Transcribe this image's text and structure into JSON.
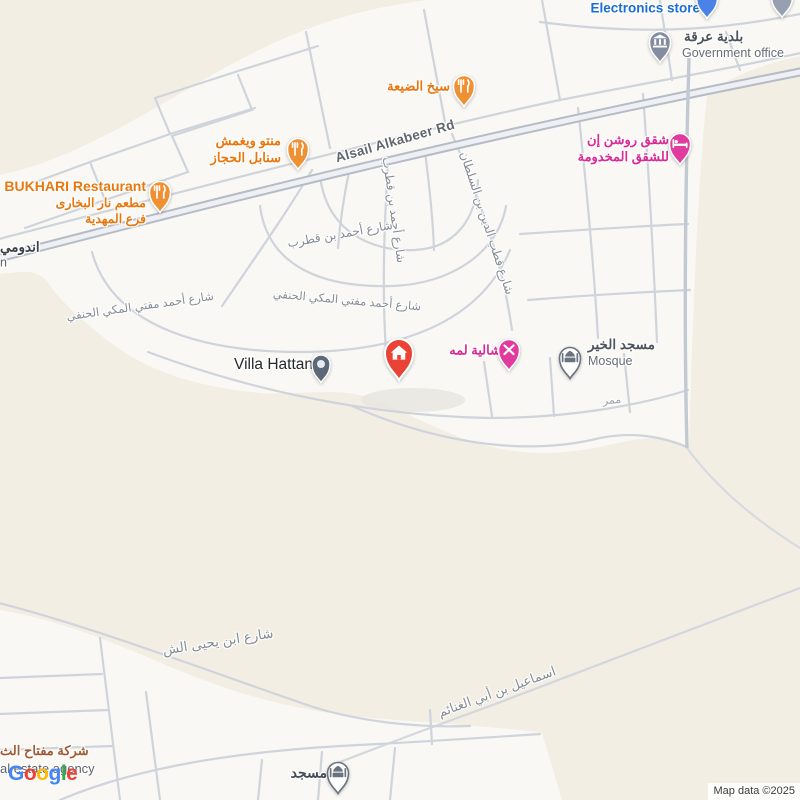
{
  "attribution": "Map data ©2025",
  "logo": {
    "letters": [
      "G",
      "o",
      "o",
      "g",
      "l",
      "e"
    ]
  },
  "colors": {
    "land": "#f2eee3",
    "urban": "#f9f8f4",
    "road": "#cfd4dc",
    "restaurant_label": "#e8770f",
    "pink_label": "#d92a95",
    "blue_label": "#1a6dd8",
    "civic_label": "#4c535b",
    "street_label": "#858c96",
    "red_pin": "#ea4335",
    "marker_orange": "#ef9133",
    "marker_pink": "#e23ba0",
    "marker_blue": "#4a82e8",
    "marker_gray": "#848da0"
  },
  "roads": {
    "alsail": "Alsail Alkabeer Rd",
    "qatrab_v": "شارع أحمد بن قطرب",
    "qatrab_h": "شارع أحمد بن قطرب",
    "mufti_a": "شارع أحمد مفتي المكي الحنفي",
    "mufti_b": "شارع أحمد مفتي المكي الحنفي",
    "qutb": "شارع قطب الدين بن السلطان",
    "yahya": "شارع ابن يحيى الش",
    "ismail": "اسماعيل بن أبي الغنائم",
    "mamarr": "ممر"
  },
  "pois": {
    "electronics": {
      "name": "Electronics store",
      "icon": "pin-icon"
    },
    "government": {
      "name": "بلدية عرقة",
      "subtitle": "Government office",
      "icon": "bank-icon"
    },
    "sikh": {
      "name": "سيخ الضيعة",
      "icon": "restaurant-icon"
    },
    "manto": {
      "line1": "منتو ويغمش",
      "line2": "سنابل الحجاز",
      "icon": "restaurant-icon"
    },
    "bukhari": {
      "name": "BUKHARI Restaurant",
      "line1": "مطعم نار البخاری",
      "line2": "فرع المهدية",
      "icon": "restaurant-icon"
    },
    "andomi": {
      "name": "اندومي",
      "subtitle": "n"
    },
    "roshan": {
      "line1": "شقق روشن إن",
      "line2": "للشقق المخدومة",
      "icon": "bed-icon"
    },
    "villa": {
      "name": "Villa Hattan",
      "icon": "dot-icon"
    },
    "red_property": {
      "icon": "house-icon"
    },
    "shaliya": {
      "name": "شالية لمه",
      "icon": "activity-icon"
    },
    "mosque_khair": {
      "name": "مسجد الخير",
      "subtitle": "Mosque",
      "icon": "mosque-icon"
    },
    "mosque_south": {
      "name": "مسجد",
      "icon": "mosque-icon"
    },
    "realestate": {
      "line1": "شركة مفتاح الث",
      "line2": "al estate agency"
    }
  }
}
